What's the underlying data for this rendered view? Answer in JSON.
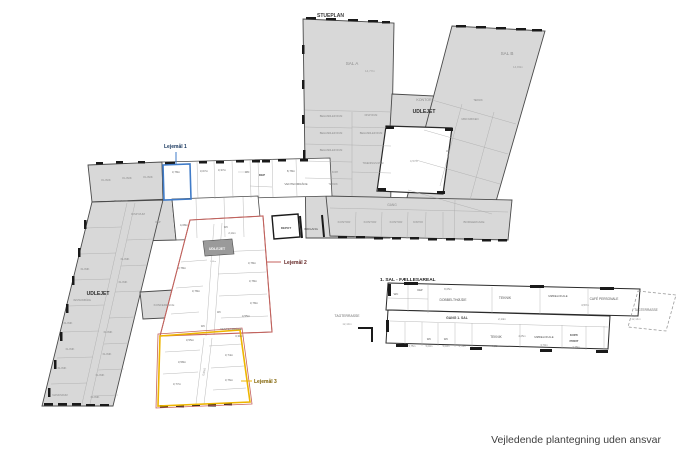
{
  "plans": {
    "ground": {
      "title": "STUEPLAN"
    },
    "first": {
      "title": "1. SAL - FÆLLESAREAL"
    }
  },
  "footer": {
    "disclaimer": "Vejledende plantegning uden ansvar"
  },
  "colors": {
    "rented_fill": "#d8d8d8",
    "vacant_fill": "#ffffff",
    "wall": "#3a3a3a",
    "room_line": "#a8a8a8",
    "label_text": "#8a8a8a"
  },
  "leases": [
    {
      "label": "Lejemål 1",
      "color": "#3f7bc8",
      "label_color": "#17365d"
    },
    {
      "label": "Lejemål 2",
      "color": "#c4615c",
      "label_color": "#632423"
    },
    {
      "label": "Lejemål 3",
      "color": "#eeb500",
      "label_color": "#7f6000"
    }
  ],
  "labels": [
    {
      "t": "SAL A",
      "x": 352,
      "y": 65,
      "s": 4.6
    },
    {
      "t": "14,77m",
      "x": 370,
      "y": 72,
      "s": 3,
      "c": "#9a9a9a"
    },
    {
      "t": "SAL B",
      "x": 507,
      "y": 55,
      "s": 4.6
    },
    {
      "t": "14,80m",
      "x": 518,
      "y": 68,
      "s": 3,
      "c": "#9a9a9a"
    },
    {
      "t": "KONTOR",
      "x": 424,
      "y": 101,
      "s": 3.6
    },
    {
      "t": "UDLEJET",
      "x": 424,
      "y": 113,
      "s": 5,
      "w": 700,
      "c": "#2b2b2b"
    },
    {
      "t": "BEHANDLER RUM",
      "x": 331,
      "y": 117,
      "s": 2.6
    },
    {
      "t": "DISP RUM",
      "x": 371,
      "y": 116,
      "s": 2.6
    },
    {
      "t": "BEHANDLER RUM",
      "x": 331,
      "y": 134,
      "s": 2.6
    },
    {
      "t": "BEHANDLER RUM",
      "x": 371,
      "y": 134,
      "s": 2.6
    },
    {
      "t": "BEHANDLER RUM",
      "x": 331,
      "y": 151,
      "s": 2.6
    },
    {
      "t": "TRÆNINGS RUM",
      "x": 373,
      "y": 164,
      "s": 2.6
    },
    {
      "t": "KOPI",
      "x": 335,
      "y": 173,
      "s": 2.6
    },
    {
      "t": "TEKNIK",
      "x": 333,
      "y": 185,
      "s": 2.6
    },
    {
      "t": "TEKNIK",
      "x": 478,
      "y": 101,
      "s": 2.6
    },
    {
      "t": "MINI KØKKEN",
      "x": 470,
      "y": 120,
      "s": 2.6
    },
    {
      "t": "WC",
      "x": 448,
      "y": 152,
      "s": 2.4
    },
    {
      "t": "4,57m",
      "x": 414,
      "y": 162,
      "s": 3,
      "c": "#9a9a9a"
    },
    {
      "t": "GANG",
      "x": 392,
      "y": 206,
      "s": 3.2
    },
    {
      "t": "KONTOR",
      "x": 344,
      "y": 223,
      "s": 3
    },
    {
      "t": "KONTOR",
      "x": 370,
      "y": 223,
      "s": 3
    },
    {
      "t": "KONTOR",
      "x": 396,
      "y": 223,
      "s": 3
    },
    {
      "t": "KONTOR",
      "x": 418,
      "y": 223,
      "s": 2.3
    },
    {
      "t": "BORGERCAFE",
      "x": 474,
      "y": 223,
      "s": 3
    },
    {
      "t": "KLINIK",
      "x": 106,
      "y": 181,
      "s": 3
    },
    {
      "t": "KLINIK",
      "x": 127,
      "y": 179,
      "s": 3
    },
    {
      "t": "KLINIK",
      "x": 148,
      "y": 178,
      "s": 3
    },
    {
      "t": "3,78m",
      "x": 176,
      "y": 173,
      "s": 3,
      "c": "#6a6a6a"
    },
    {
      "t": "3,07m",
      "x": 204,
      "y": 172,
      "s": 3,
      "c": "#6a6a6a"
    },
    {
      "t": "3,37m",
      "x": 222,
      "y": 171,
      "s": 3,
      "c": "#6a6a6a"
    },
    {
      "t": "WC",
      "x": 247,
      "y": 173,
      "s": 2.4,
      "c": "#6a6a6a"
    },
    {
      "t": "DEP",
      "x": 262,
      "y": 176,
      "s": 3,
      "w": 600,
      "c": "#4a4a4a"
    },
    {
      "t": "8,78m",
      "x": 291,
      "y": 172,
      "s": 3,
      "c": "#6a6a6a"
    },
    {
      "t": "VENTEOMRÅDE",
      "x": 296,
      "y": 185,
      "s": 3,
      "c": "#6a6a6a"
    },
    {
      "t": "GANG",
      "x": 118,
      "y": 202,
      "s": 2.8
    },
    {
      "t": "DISP RUM",
      "x": 138,
      "y": 215,
      "s": 2.8
    },
    {
      "t": "DEP",
      "x": 158,
      "y": 223,
      "s": 2.6
    },
    {
      "t": "4,08m",
      "x": 184,
      "y": 226,
      "s": 3,
      "c": "#6a6a6a"
    },
    {
      "t": "WC",
      "x": 226,
      "y": 228,
      "s": 2.6,
      "c": "#6a6a6a"
    },
    {
      "t": "2,14m",
      "x": 232,
      "y": 234,
      "s": 2.6,
      "c": "#6a6a6a"
    },
    {
      "t": "DEPOT",
      "x": 286,
      "y": 229,
      "s": 3,
      "w": 600,
      "c": "#4a4a4a"
    },
    {
      "t": "INDGANG",
      "x": 311,
      "y": 230,
      "s": 3,
      "c": "#4a4a4a"
    },
    {
      "t": "UDLEJET",
      "x": 98,
      "y": 295,
      "s": 5,
      "w": 700,
      "c": "#2b2b2b"
    },
    {
      "t": "VENTEOMRÅDE",
      "x": 82,
      "y": 301,
      "s": 2.3
    },
    {
      "t": "KLINIK",
      "x": 125,
      "y": 260,
      "s": 2.8
    },
    {
      "t": "KLINIK",
      "x": 85,
      "y": 270,
      "s": 2.8
    },
    {
      "t": "KLINIK",
      "x": 123,
      "y": 283,
      "s": 2.8
    },
    {
      "t": "KLINIK",
      "x": 68,
      "y": 324,
      "s": 2.8
    },
    {
      "t": "KLINIK",
      "x": 108,
      "y": 333,
      "s": 2.8
    },
    {
      "t": "KLINIK",
      "x": 70,
      "y": 350,
      "s": 2.8
    },
    {
      "t": "KLINIK",
      "x": 107,
      "y": 355,
      "s": 2.8
    },
    {
      "t": "KLINIK",
      "x": 62,
      "y": 369,
      "s": 2.8
    },
    {
      "t": "KLINIK",
      "x": 100,
      "y": 376,
      "s": 2.8
    },
    {
      "t": "KLINIK",
      "x": 95,
      "y": 398,
      "s": 2.8
    },
    {
      "t": "MASKINRUM",
      "x": 60,
      "y": 396,
      "s": 2.5
    },
    {
      "t": "KONFERENCE",
      "x": 164,
      "y": 306,
      "s": 3
    },
    {
      "t": "UDLEJET",
      "x": 217,
      "y": 250,
      "s": 3.6,
      "w": 600,
      "c": "#ffffff"
    },
    {
      "t": "3,78m",
      "x": 182,
      "y": 269,
      "s": 3,
      "c": "#6a6a6a"
    },
    {
      "t": "3,78m",
      "x": 196,
      "y": 292,
      "s": 3,
      "c": "#6a6a6a"
    },
    {
      "t": "WC",
      "x": 203,
      "y": 327,
      "s": 2.6,
      "c": "#6a6a6a"
    },
    {
      "t": "WC",
      "x": 219,
      "y": 313,
      "s": 2.4,
      "c": "#6a6a6a"
    },
    {
      "t": "1,48m",
      "x": 213,
      "y": 262,
      "s": 2.2,
      "c": "#9a9a9a"
    },
    {
      "t": "3,78m",
      "x": 252,
      "y": 264,
      "s": 3,
      "c": "#6a6a6a"
    },
    {
      "t": "3,78m",
      "x": 253,
      "y": 282,
      "s": 3,
      "c": "#6a6a6a"
    },
    {
      "t": "3,78m",
      "x": 254,
      "y": 304,
      "s": 3,
      "c": "#6a6a6a"
    },
    {
      "t": "4,55m",
      "x": 246,
      "y": 317,
      "s": 3,
      "c": "#6a6a6a"
    },
    {
      "t": "VENTEOMRÅDE",
      "x": 231,
      "y": 330,
      "s": 2.8,
      "c": "#6a6a6a"
    },
    {
      "t": "3,31m",
      "x": 239,
      "y": 337,
      "s": 2.8,
      "c": "#6a6a6a"
    },
    {
      "t": "3,55m",
      "x": 190,
      "y": 341,
      "s": 3,
      "c": "#6a6a6a"
    },
    {
      "t": "3,58m",
      "x": 182,
      "y": 363,
      "s": 3,
      "c": "#6a6a6a"
    },
    {
      "t": "3,77m",
      "x": 177,
      "y": 385,
      "s": 3,
      "c": "#6a6a6a"
    },
    {
      "t": "3,74m",
      "x": 229,
      "y": 356,
      "s": 3,
      "c": "#6a6a6a"
    },
    {
      "t": "3,76m",
      "x": 229,
      "y": 381,
      "s": 3,
      "c": "#6a6a6a"
    },
    {
      "t": "GANG",
      "x": 205,
      "y": 372,
      "s": 2.8,
      "r": -78,
      "c": "#9a9a9a"
    },
    {
      "t": "TAGTERRASSE",
      "x": 347,
      "y": 317,
      "s": 3.4,
      "c": "#6a6a6a"
    },
    {
      "t": "12,10m",
      "x": 347,
      "y": 325,
      "s": 2.8,
      "c": "#9a9a9a"
    },
    {
      "t": "WC",
      "x": 396,
      "y": 295,
      "s": 2.8,
      "c": "#555555"
    },
    {
      "t": "DEP",
      "x": 420,
      "y": 291,
      "s": 2.6,
      "c": "#555555"
    },
    {
      "t": "8,05m",
      "x": 448,
      "y": 290,
      "s": 2.8,
      "c": "#808080"
    },
    {
      "t": "DOBBELTHØJDE",
      "x": 453,
      "y": 301,
      "s": 3.4,
      "c": "#555555"
    },
    {
      "t": "TEKNIK",
      "x": 505,
      "y": 299,
      "s": 3.4,
      "c": "#555555"
    },
    {
      "t": "MØDELOKALE",
      "x": 558,
      "y": 297,
      "s": 2.8,
      "c": "#555555"
    },
    {
      "t": "CAFÉ PERSONALE",
      "x": 604,
      "y": 300,
      "s": 3.2,
      "c": "#555555"
    },
    {
      "t": "4,57m",
      "x": 585,
      "y": 306,
      "s": 2.8,
      "c": "#808080"
    },
    {
      "t": "TAGTERRASSE",
      "x": 646,
      "y": 311,
      "s": 3.2,
      "c": "#6a6a6a"
    },
    {
      "t": "12,14m",
      "x": 636,
      "y": 320,
      "s": 2.8,
      "c": "#9a9a9a"
    },
    {
      "t": "GANG 1. SAL",
      "x": 457,
      "y": 319,
      "s": 3.4,
      "w": 600,
      "c": "#474747"
    },
    {
      "t": "2,14m",
      "x": 502,
      "y": 320,
      "s": 2.8,
      "c": "#808080"
    },
    {
      "t": "WC",
      "x": 429,
      "y": 340,
      "s": 2.6,
      "c": "#555555"
    },
    {
      "t": "WC",
      "x": 446,
      "y": 340,
      "s": 2.6,
      "c": "#555555"
    },
    {
      "t": "5,75m",
      "x": 412,
      "y": 347,
      "s": 2.4,
      "c": "#808080"
    },
    {
      "t": "5,00m",
      "x": 429,
      "y": 347,
      "s": 2.4,
      "c": "#808080"
    },
    {
      "t": "5,00m",
      "x": 446,
      "y": 347,
      "s": 2.4,
      "c": "#808080"
    },
    {
      "t": "5,75m",
      "x": 462,
      "y": 347,
      "s": 2.4,
      "c": "#808080"
    },
    {
      "t": "TEKNIK",
      "x": 496,
      "y": 338,
      "s": 3.2,
      "c": "#555555"
    },
    {
      "t": "9,25m",
      "x": 496,
      "y": 347,
      "s": 2.8,
      "c": "#808080"
    },
    {
      "t": "MØDELOKALE",
      "x": 544,
      "y": 338,
      "s": 2.8,
      "c": "#555555"
    },
    {
      "t": "4,25m",
      "x": 522,
      "y": 337,
      "s": 2.6,
      "c": "#808080"
    },
    {
      "t": "3,70m",
      "x": 544,
      "y": 346,
      "s": 2.6,
      "c": "#808080"
    },
    {
      "t": "KOPI/",
      "x": 574,
      "y": 336,
      "s": 3,
      "w": 600,
      "c": "#555555"
    },
    {
      "t": "PRINT",
      "x": 574,
      "y": 342,
      "s": 3,
      "w": 600,
      "c": "#555555"
    },
    {
      "t": "3,78m",
      "x": 576,
      "y": 348,
      "s": 2.6,
      "c": "#808080"
    }
  ]
}
